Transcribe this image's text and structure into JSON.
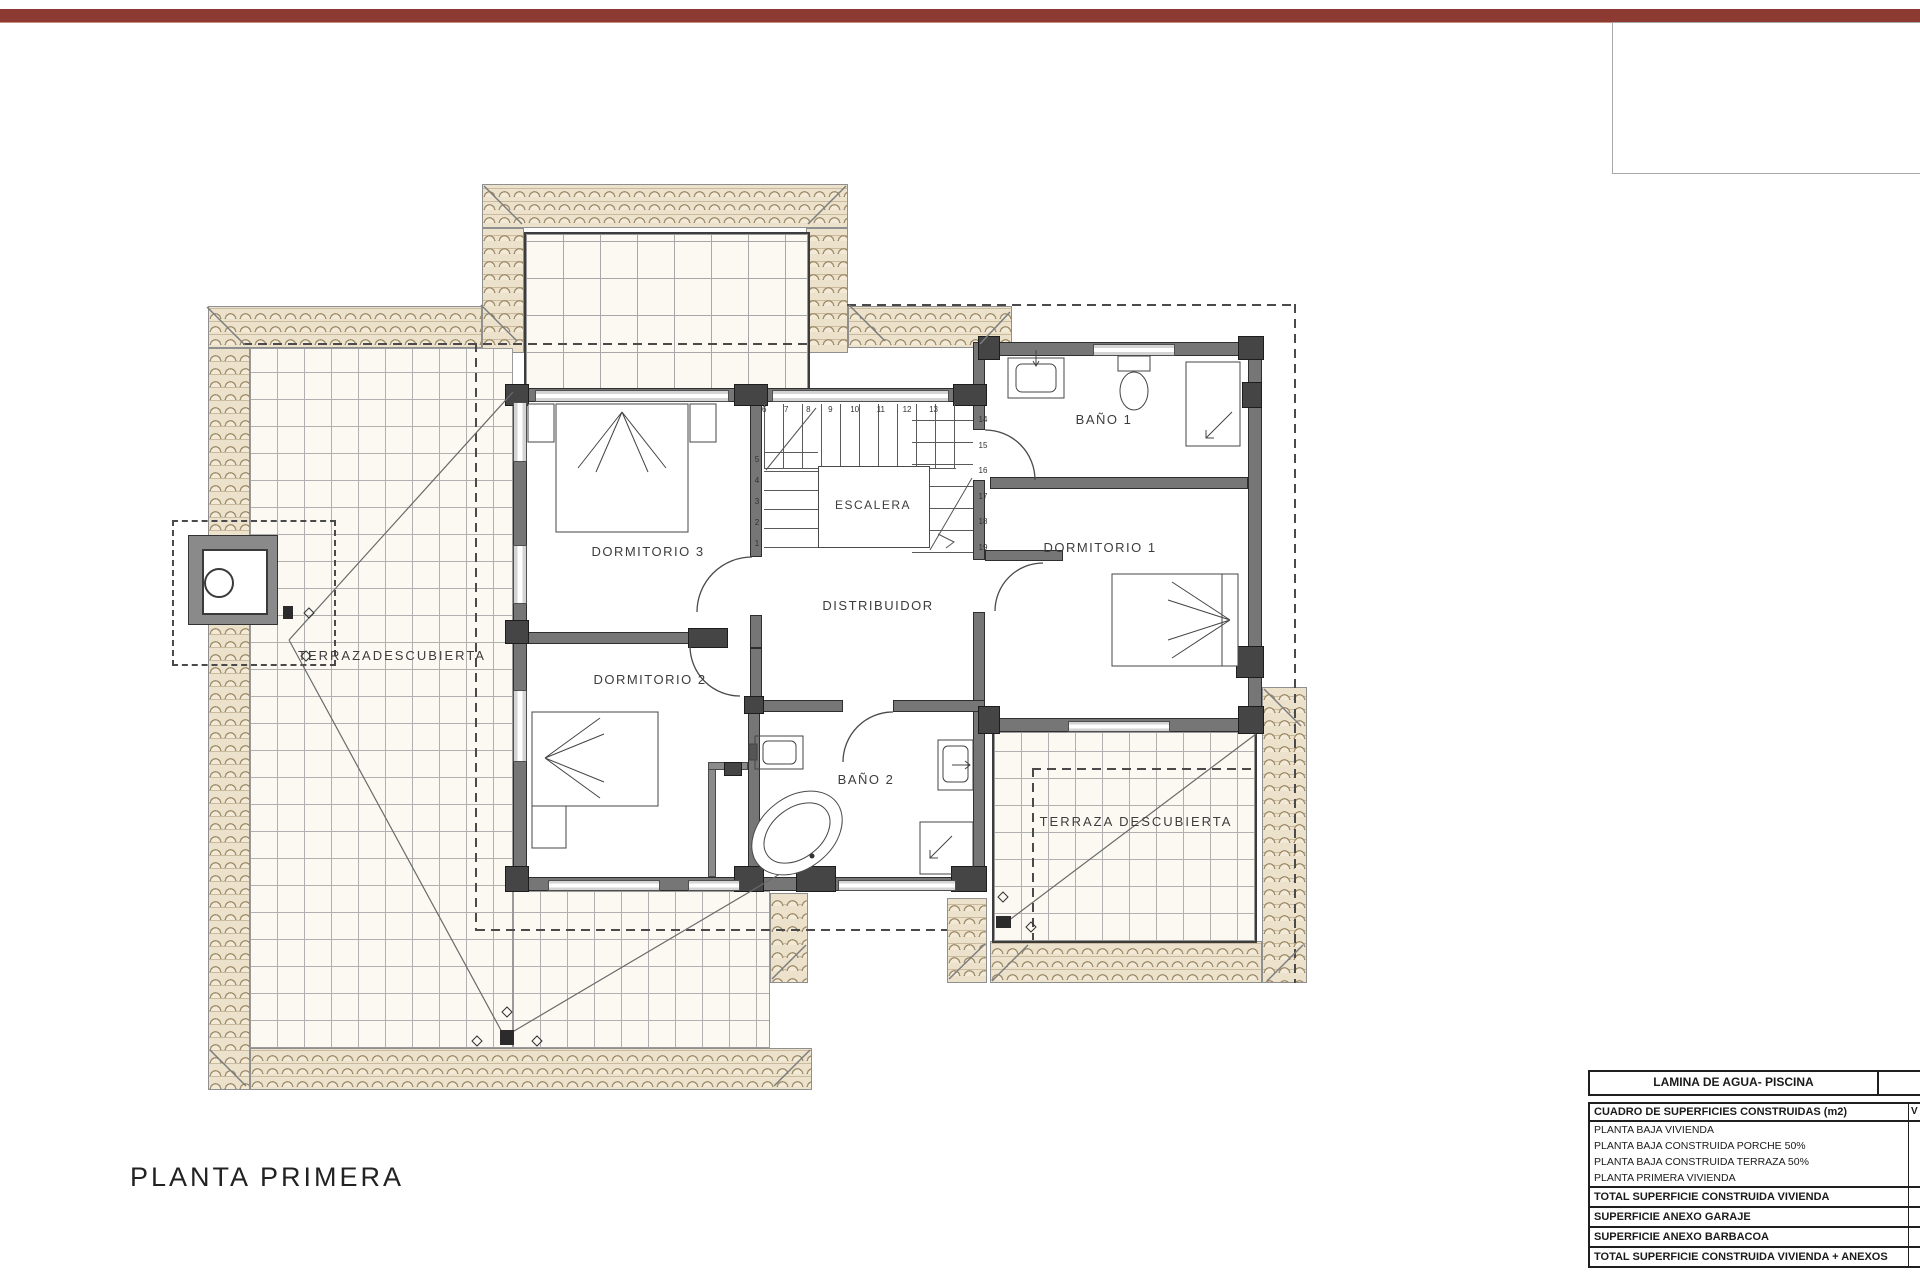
{
  "window": {
    "accent_bar_color": "#8d3b32"
  },
  "plan": {
    "title": "PLANTA PRIMERA",
    "rooms": {
      "dormitorio_3": "DORMITORIO 3",
      "dormitorio_2": "DORMITORIO 2",
      "dormitorio_1": "DORMITORIO 1",
      "bano_1": "BAÑO 1",
      "bano_2": "BAÑO 2",
      "escalera": "ESCALERA",
      "distribuidor": "DISTRIBUIDOR",
      "terraza_izquierda": "TERRAZADESCUBIERTA",
      "terraza_derecha": "TERRAZA DESCUBIERTA"
    },
    "stairs": {
      "top_numbers": [
        "6",
        "7",
        "8",
        "9",
        "10",
        "11",
        "12",
        "13"
      ],
      "right_numbers": [
        "14",
        "15",
        "16",
        "17",
        "18",
        "19"
      ],
      "left_numbers": [
        "5",
        "4",
        "3",
        "2",
        "1"
      ]
    }
  },
  "tables": {
    "pool_row": {
      "label": "LAMINA DE AGUA- PISCINA",
      "value": ""
    },
    "areas": {
      "header": {
        "label": "CUADRO DE SUPERFICIES CONSTRUIDAS (m2)",
        "value": "V"
      },
      "rows": [
        {
          "label": "PLANTA BAJA VIVIENDA",
          "value": ""
        },
        {
          "label": "PLANTA BAJA CONSTRUIDA PORCHE 50%",
          "value": ""
        },
        {
          "label": "PLANTA BAJA CONSTRUIDA TERRAZA 50%",
          "value": ""
        },
        {
          "label": "PLANTA PRIMERA VIVIENDA",
          "value": ""
        }
      ],
      "totals": [
        {
          "label": "TOTAL SUPERFICIE CONSTRUIDA VIVIENDA",
          "value": ""
        },
        {
          "label": "SUPERFICIE ANEXO GARAJE",
          "value": ""
        },
        {
          "label": "SUPERFICIE ANEXO BARBACOA",
          "value": ""
        },
        {
          "label": "TOTAL SUPERFICIE CONSTRUIDA VIVIENDA + ANEXOS",
          "value": ""
        }
      ]
    }
  }
}
